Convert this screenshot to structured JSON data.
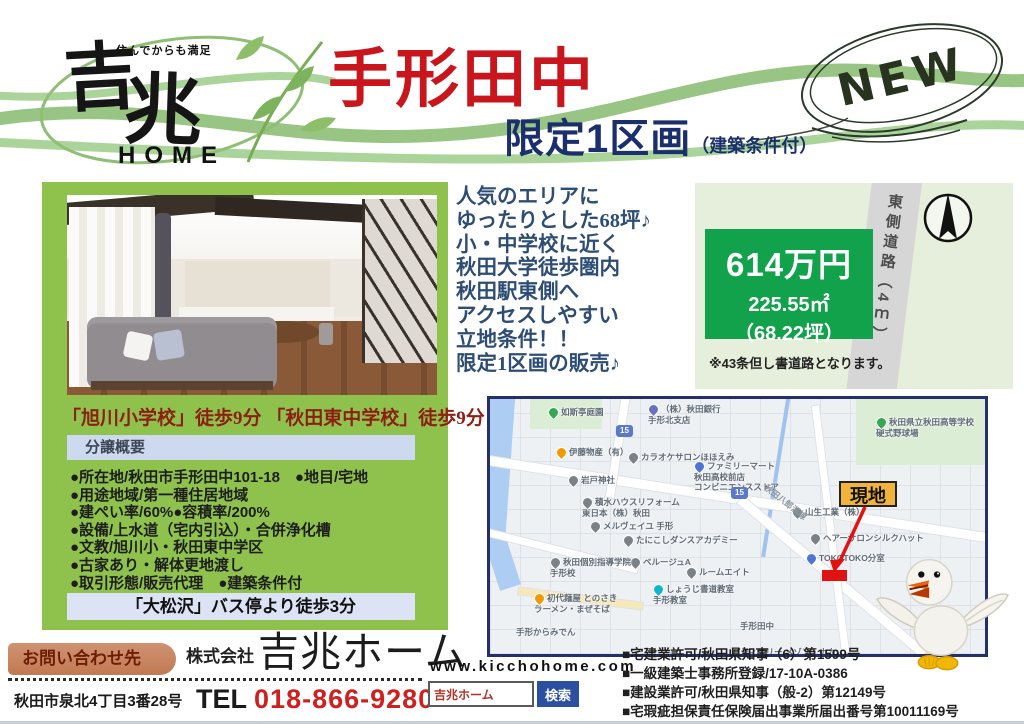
{
  "header": {
    "tagline": "住んでからも満足",
    "brand": "吉兆",
    "brand_home": "HOME",
    "title": "手形田中",
    "subtitle": "限定1区画",
    "subtitle_note": "（建築条件付）",
    "new_badge": "NEW"
  },
  "lead": {
    "lines": [
      "人気のエリアに",
      "ゆったりとした68坪♪",
      "小・中学校に近く",
      "秋田大学徒歩圏内",
      "秋田駅東側へ",
      "アクセスしやすい",
      "立地条件！！",
      "限定1区画の販売♪"
    ]
  },
  "price": {
    "amount": "614万円",
    "area_sqm": "225.55㎡",
    "area_tsubo": "（68.22坪）",
    "note": "※43条但し書道路となります。",
    "road_label": "東側道路（4ｍ）"
  },
  "land": {
    "schools": "「旭川小学校」徒歩9分 「秋田東中学校」徒歩9分",
    "overview_header": "分譲概要",
    "items": [
      "●所在地/秋田市手形田中101-18　●地目/宅地",
      "●用途地域/第一種住居地域",
      "●建ぺい率/60%●容積率/200%",
      "●設備/上水道（宅内引込）・合併浄化槽",
      "●文教/旭川小・秋田東中学区",
      "●古家あり・解体更地渡し",
      "●取引形態/販売代理　●建築条件付"
    ],
    "bus": "「大松沢」バス停より徒歩3分"
  },
  "map": {
    "site_label": "現地",
    "labels": [
      {
        "text": "如斯亭庭園",
        "x": 58,
        "y": 8,
        "pin": "#34a853"
      },
      {
        "text": "（株）秋田銀行\n手形北支店",
        "x": 158,
        "y": 5,
        "pin": "#6672c4"
      },
      {
        "text": "伊藤物産（有）",
        "x": 66,
        "y": 48,
        "pin": "#f29900"
      },
      {
        "text": "カラオケサロンほほえみ",
        "x": 138,
        "y": 53,
        "pin": "#7a8288"
      },
      {
        "text": "ファミリーマート\n秋田高校前店\nコンビニエンスストア",
        "x": 204,
        "y": 62,
        "pin": "#4f74d9"
      },
      {
        "text": "岩戸神社",
        "x": 78,
        "y": 76,
        "pin": "#7a8288"
      },
      {
        "text": "積水ハウスリフォーム\n東日本（株）秋田",
        "x": 92,
        "y": 98,
        "pin": "#7a8288"
      },
      {
        "text": "メルヴェイユ 手形",
        "x": 100,
        "y": 122,
        "pin": "#7a8288"
      },
      {
        "text": "たにこしダンスアカデミー",
        "x": 133,
        "y": 136,
        "pin": "#7a8288"
      },
      {
        "text": "ベルージュA",
        "x": 140,
        "y": 158,
        "pin": "#7a8288"
      },
      {
        "text": "ルームエイト",
        "x": 196,
        "y": 168,
        "pin": "#7a8288"
      },
      {
        "text": "秋田個別指導学院\n手形校",
        "x": 60,
        "y": 158,
        "pin": "#7a8288"
      },
      {
        "text": "しょうじ書道教室\n手形教室",
        "x": 163,
        "y": 185,
        "pin": "#12b5cb"
      },
      {
        "text": "初代麺屋 とのさき\nラーメン・まぜそば",
        "x": 44,
        "y": 194,
        "pin": "#f29900"
      },
      {
        "text": "手形からみでん",
        "x": 26,
        "y": 228
      },
      {
        "text": "手形田中",
        "x": 250,
        "y": 222
      },
      {
        "text": "パティスリー メゾン・ナカ",
        "x": 242,
        "y": 248
      },
      {
        "text": "ヘアーサロンシルクハット",
        "x": 320,
        "y": 134,
        "pin": "#7a8288"
      },
      {
        "text": "TOKOTOKO分室",
        "x": 316,
        "y": 154,
        "pin": "#4f74d9"
      },
      {
        "text": "山生工業（株）",
        "x": 302,
        "y": 108,
        "pin": "#7a8288"
      },
      {
        "text": "秋田県立秋田高等学校\n硬式野球場",
        "x": 386,
        "y": 18,
        "pin": "#34a853"
      },
      {
        "text": "秋田八郎潟線",
        "x": 270,
        "y": 98,
        "rotate": 38,
        "cls": "roadname"
      },
      {
        "text": "15",
        "x": 241,
        "y": 88,
        "cls": "badge"
      },
      {
        "text": "15",
        "x": 126,
        "y": 26,
        "cls": "badge"
      }
    ]
  },
  "contact": {
    "badge": "お問い合わせ先",
    "company_prefix": "株式会社",
    "company_name": "吉兆ホーム",
    "address": "秋田市泉北4丁目3番28号",
    "tel_label": "TEL",
    "tel_number": "018-866-9280",
    "website": "www.kicchohome.com",
    "search_value": "吉兆ホーム",
    "search_button": "検索",
    "licenses": [
      "■宅建業許可/秋田県知事（6）第1599号",
      "■一級建築士事務所登録/17-10A-0386",
      "■建設業許可/秋田県知事（般-2）第12149号",
      "■宅瑕疵担保責任保険届出事業所届出番号第10011169号"
    ]
  },
  "colors": {
    "accent_green": "#8fc24d",
    "price_green": "#12a24b",
    "title_red": "#c9161d",
    "navy": "#1a2f6b",
    "site_marker_red": "#e01212"
  }
}
